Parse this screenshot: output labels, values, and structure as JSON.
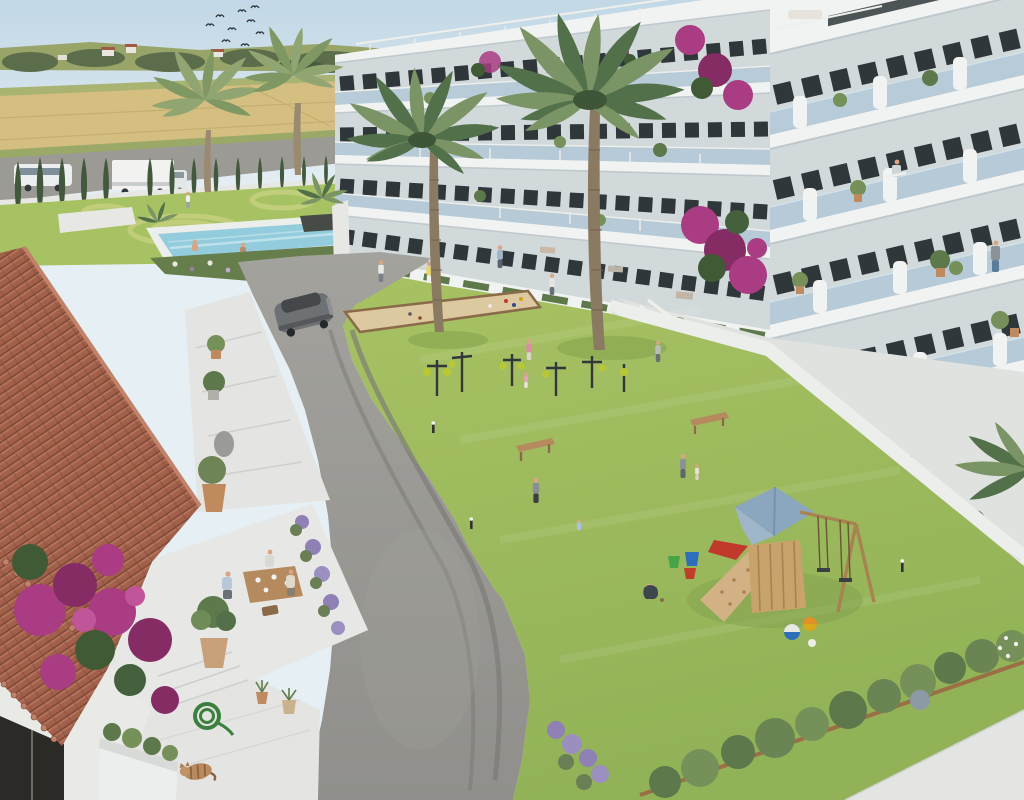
{
  "meta": {
    "type": "architectural-3d-render",
    "description": "Aerial render of a modern white apartment complex with communal garden, pool, playground, outdoor gym and a terracotta-roofed clubhouse",
    "width": 1024,
    "height": 800
  },
  "palette": {
    "sky-top": "#c2d8e6",
    "sky-low": "#e6eff4",
    "hill": "#98a468",
    "treeline": "#5b6d4b",
    "wheat": "#d4bf80",
    "wheat-dark": "#c0a96a",
    "field-green": "#a9b472",
    "back-road": "#9b9a94",
    "fence": "#e7e8e4",
    "cypress": "#42583c",
    "bldg-white": "#f1f3f2",
    "bldg-shade": "#d2d9db",
    "slab-shadow": "#b9c3c8",
    "glass": "#b4cad7",
    "glass-light": "#d2e1e8",
    "window": "#2f373b",
    "grass": "#92b257",
    "grass-light": "#a7c263",
    "grass-pale": "#c4cf7d",
    "grass-dark": "#7d9c4a",
    "pool": "#93ccdc",
    "pool-light": "#bde2ec",
    "deck": "#eceeeb",
    "asphalt": "#908f8b",
    "asphalt-light": "#a3a29d",
    "asphalt-dark": "#7b7a76",
    "sand": "#dcc9a0",
    "wood": "#b58a5e",
    "wood-dark": "#8a6a48",
    "roof": "#a2604a",
    "roof-light": "#c08268",
    "roof-dark": "#7c4636",
    "stone": "#e4e5e2",
    "stone-shade": "#cdd0cd",
    "magenta": "#a93c82",
    "magenta-dark": "#842c63",
    "lavender": "#8f80b5",
    "shrub": "#5d784a",
    "shrub-light": "#76905a",
    "palm": "#52704a",
    "palm-light": "#7a9465",
    "palm-pale": "#90a571",
    "trunk": "#8b7a62",
    "play-wood": "#c9a36b",
    "play-wood-dark": "#a98250",
    "play-roof": "#8ba6bf",
    "red-accent": "#c0392b",
    "suv": "#6e7173",
    "suv-dark": "#44484a",
    "skin": "#d9a583",
    "white-soft": "#efefec",
    "hose-green": "#3c7f3f",
    "pot-clay": "#c08a5f",
    "cat-fur": "#b98a5e"
  },
  "scene": {
    "sky": "pale clear sky with flock of swallows",
    "background": "countryside with wheat fields, distant farmhouses, road with white van, box truck and red car, cypress hedge along property wall",
    "amenities": [
      "swimming pool with two bathers",
      "ornamental mown lawn circles",
      "rock pond",
      "petanque (bocce) sand court",
      "outdoor gym equipment",
      "wooden playground with blue roof, climbing wall and double swing",
      "garden benches",
      "bollard path lights"
    ],
    "buildings": [
      "long white apartment block with glass balconies and roof pergolas",
      "near white apartment wing with curved balcony walls, potted plants and residents",
      "terracotta tiled clubhouse with stepped white terraces"
    ],
    "foreground": [
      "al-fresco dining table with three people",
      "potted olive trees",
      "lavender and bougainvillea",
      "coiled green garden hose",
      "sleeping tabby cat",
      "grey SUV on curved asphalt driveway"
    ],
    "people_count": 20,
    "vehicles": [
      "grey SUV",
      "white box truck",
      "white van",
      "red car"
    ]
  }
}
